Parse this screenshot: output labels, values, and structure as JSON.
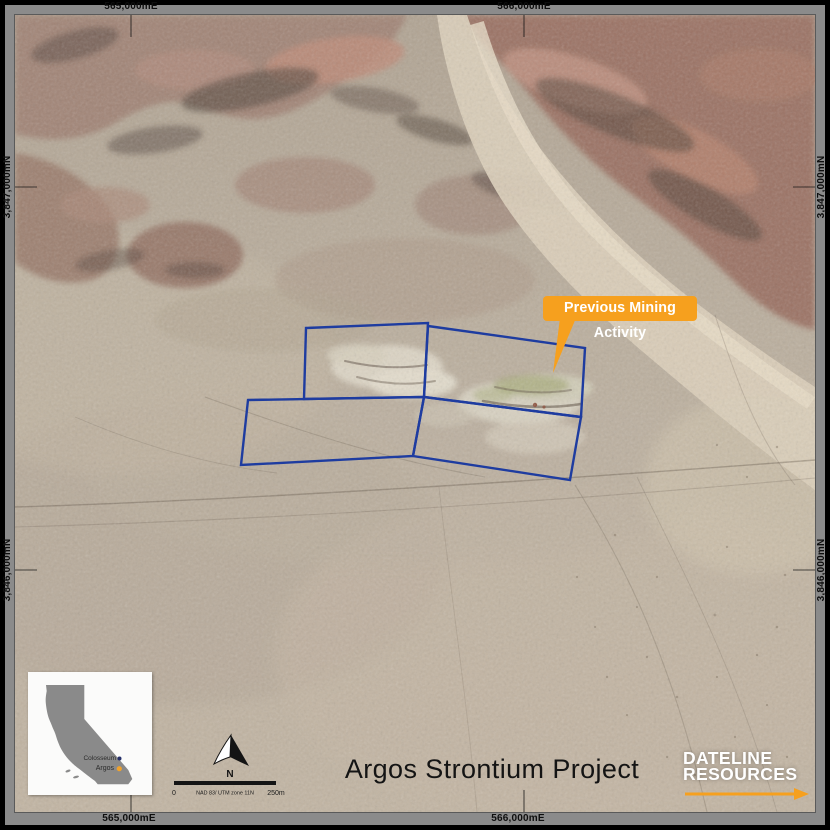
{
  "colors": {
    "accent_orange": "#F6A01E",
    "claim_blue": "#1E3CA0",
    "margin_gray": "#8B8B8B",
    "frame_black": "#000000"
  },
  "grid_labels": {
    "top": [
      "565,000mE",
      "566,000mE"
    ],
    "bottom": [
      "565,000mE",
      "566,000mE"
    ],
    "left": [
      "3,847,000mN",
      "3,846,000mN"
    ],
    "right": [
      "3,847,000mN",
      "3,846,000mN"
    ]
  },
  "callout": {
    "label": "Previous Mining Activity"
  },
  "claims": {
    "polygons": [
      "291,313 413,308 409,382 289,384",
      "413,311 570,333 566,402 409,382",
      "233,385 409,382 398,441 226,450",
      "409,382 566,402 555,465 398,441"
    ]
  },
  "inset": {
    "points": [
      {
        "label": "Colosseum",
        "color": "#27316B"
      },
      {
        "label": "Argos",
        "color": "#F0A22C"
      }
    ]
  },
  "north_arrow": {
    "label": "N"
  },
  "scale_bar": {
    "zero": "0",
    "datum": "NAD 83/ UTM zone 11N",
    "max": "250m"
  },
  "title": "Argos Strontium Project",
  "logo": {
    "line1": "DATELINE",
    "line2": "RESOURCES"
  }
}
